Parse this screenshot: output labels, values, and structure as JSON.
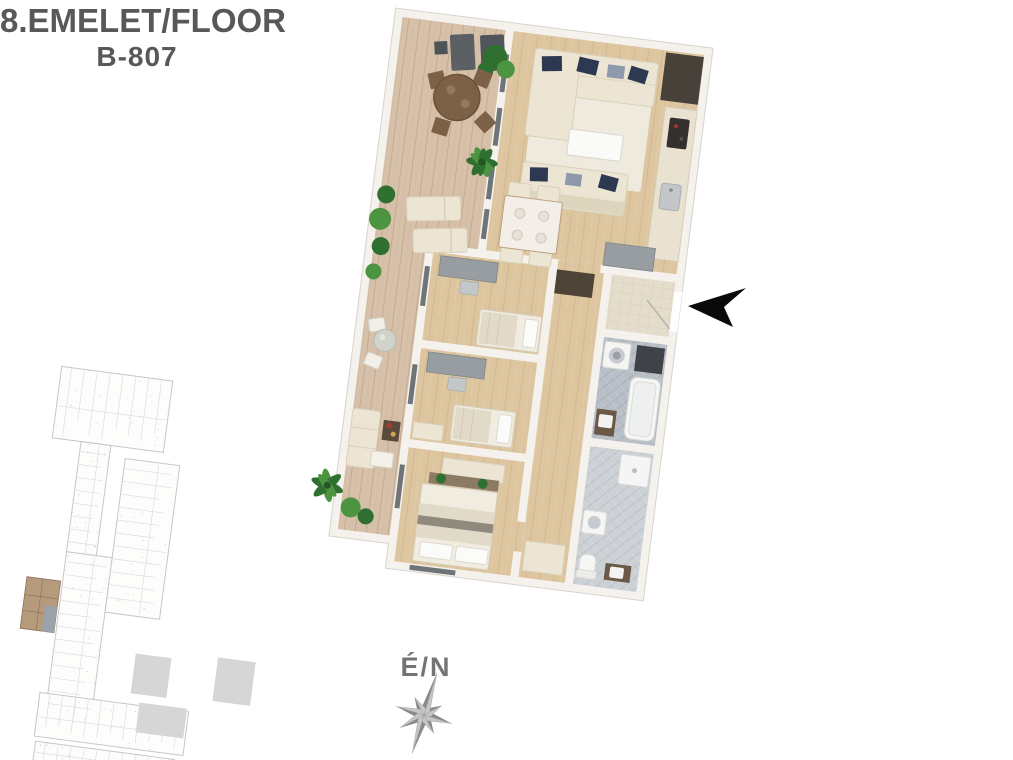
{
  "header": {
    "floor_label": "8.EMELET/FLOOR",
    "unit_label": "B-807"
  },
  "compass": {
    "label": "É/N"
  },
  "entrance": {
    "direction": "left"
  },
  "palette": {
    "title_text": "#57585a",
    "wall": "#f5f2ee",
    "wall_edge": "#d8d3cc",
    "deck": "#d6c0a9",
    "oak": "#ddc69f",
    "cream": "#ece5d3",
    "cream_dark": "#d9d0ba",
    "navy": "#2d3950",
    "gray_pillow": "#8e99ab",
    "desk": "#979da0",
    "wood_dark": "#7c6147",
    "plant": "#2f7030",
    "plant_light": "#4d9440",
    "tile_main": "#b8bfc7",
    "tile_light": "#ccd1d6",
    "beige_tile": "#e4ddcb",
    "appliance_dark": "#3f4246",
    "arrow": "#0a0a0a",
    "compass_dark": "#8a8a8a",
    "compass_light": "#c6c6c6",
    "kp_line": "#c6c6c6",
    "kp_line_light": "#dddddd",
    "kp_highlight": "#b59a7c",
    "kp_highlight_line": "#8b7054",
    "kp_gray": "#d6d6d6"
  }
}
